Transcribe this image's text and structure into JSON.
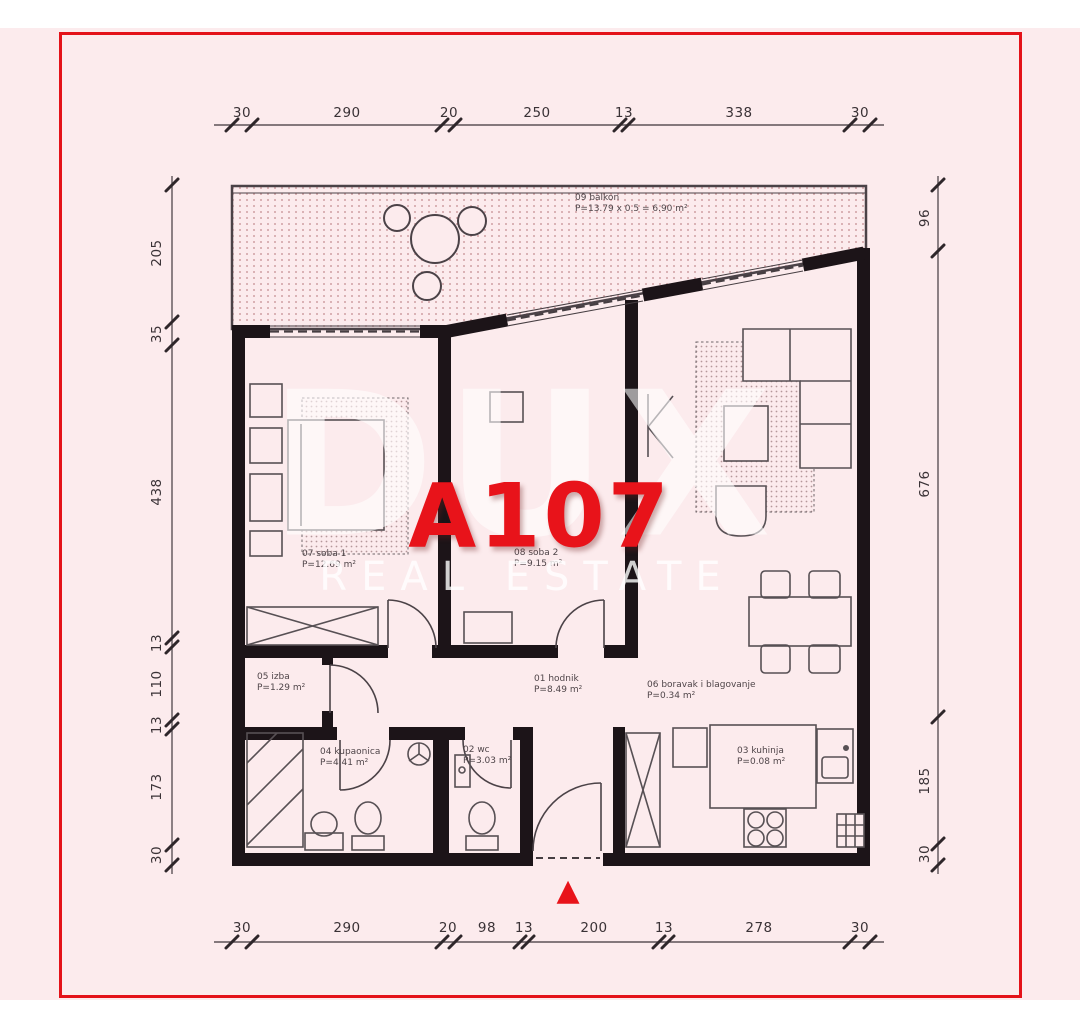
{
  "unit": {
    "label": "A107"
  },
  "watermark": {
    "brand": "DUX",
    "tagline": "REAL ESTATE"
  },
  "icons": {
    "entrance_marker": "▲"
  },
  "colors": {
    "background": "#fcebed",
    "frame_red": "#e41219",
    "accent_red": "#e8131a",
    "walls": "#1c1418",
    "linework": "#4b4247",
    "watermark_white": "#ffffff"
  },
  "rooms": [
    {
      "name": "09 balkon",
      "area": "P=13.79 x 0.5 = 6.90 m²"
    },
    {
      "name": "07 soba 1",
      "area": "P=12.69 m²"
    },
    {
      "name": "08 soba 2",
      "area": "P=9.15 m²"
    },
    {
      "name": "05 izba",
      "area": "P=1.29 m²"
    },
    {
      "name": "01 hodnik",
      "area": "P=8.49 m²"
    },
    {
      "name": "06 boravak i blagovanje",
      "area": "P=0.34 m²"
    },
    {
      "name": "04 kupaonica",
      "area": "P=4.41 m²"
    },
    {
      "name": "02 wc",
      "area": "P=3.03 m²"
    },
    {
      "name": "03 kuhinja",
      "area": "P=0.08 m²"
    }
  ],
  "dimensions": {
    "top": [
      "30",
      "290",
      "20",
      "250",
      "13",
      "338",
      "30"
    ],
    "bottom": [
      "30",
      "290",
      "20",
      "98",
      "13",
      "200",
      "13",
      "278",
      "30"
    ],
    "left": [
      "205",
      "35",
      "438",
      "13",
      "110",
      "13",
      "173",
      "30"
    ],
    "right": [
      "96",
      "676",
      "185",
      "30"
    ]
  }
}
